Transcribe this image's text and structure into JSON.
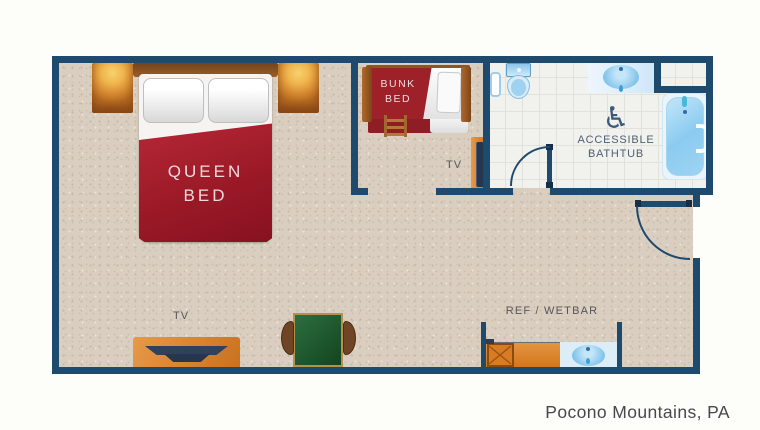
{
  "caption": "Pocono Mountains, PA",
  "labels": {
    "queen_bed_line1": "QUEEN",
    "queen_bed_line2": "BED",
    "bunk_bed_line1": "BUNK",
    "bunk_bed_line2": "BED",
    "bedroom_tv": "TV",
    "bunk_room_tv": "TV",
    "bathroom_line1": "ACCESSIBLE",
    "bathroom_line2": "BATHTUB",
    "wetbar": "REF / WETBAR"
  },
  "icons": {
    "wheelchair": "♿"
  },
  "colors": {
    "wall_navy": "#1e4a6d",
    "carpet_beige": "#d9cec0",
    "bed_red": "#9b1927",
    "wood_orange": "#d9822f",
    "table_green": "#1d5a31",
    "fixture_blue": "#8fc7e8",
    "tile_white": "#f1f1ee",
    "label_gray": "#55575a"
  }
}
